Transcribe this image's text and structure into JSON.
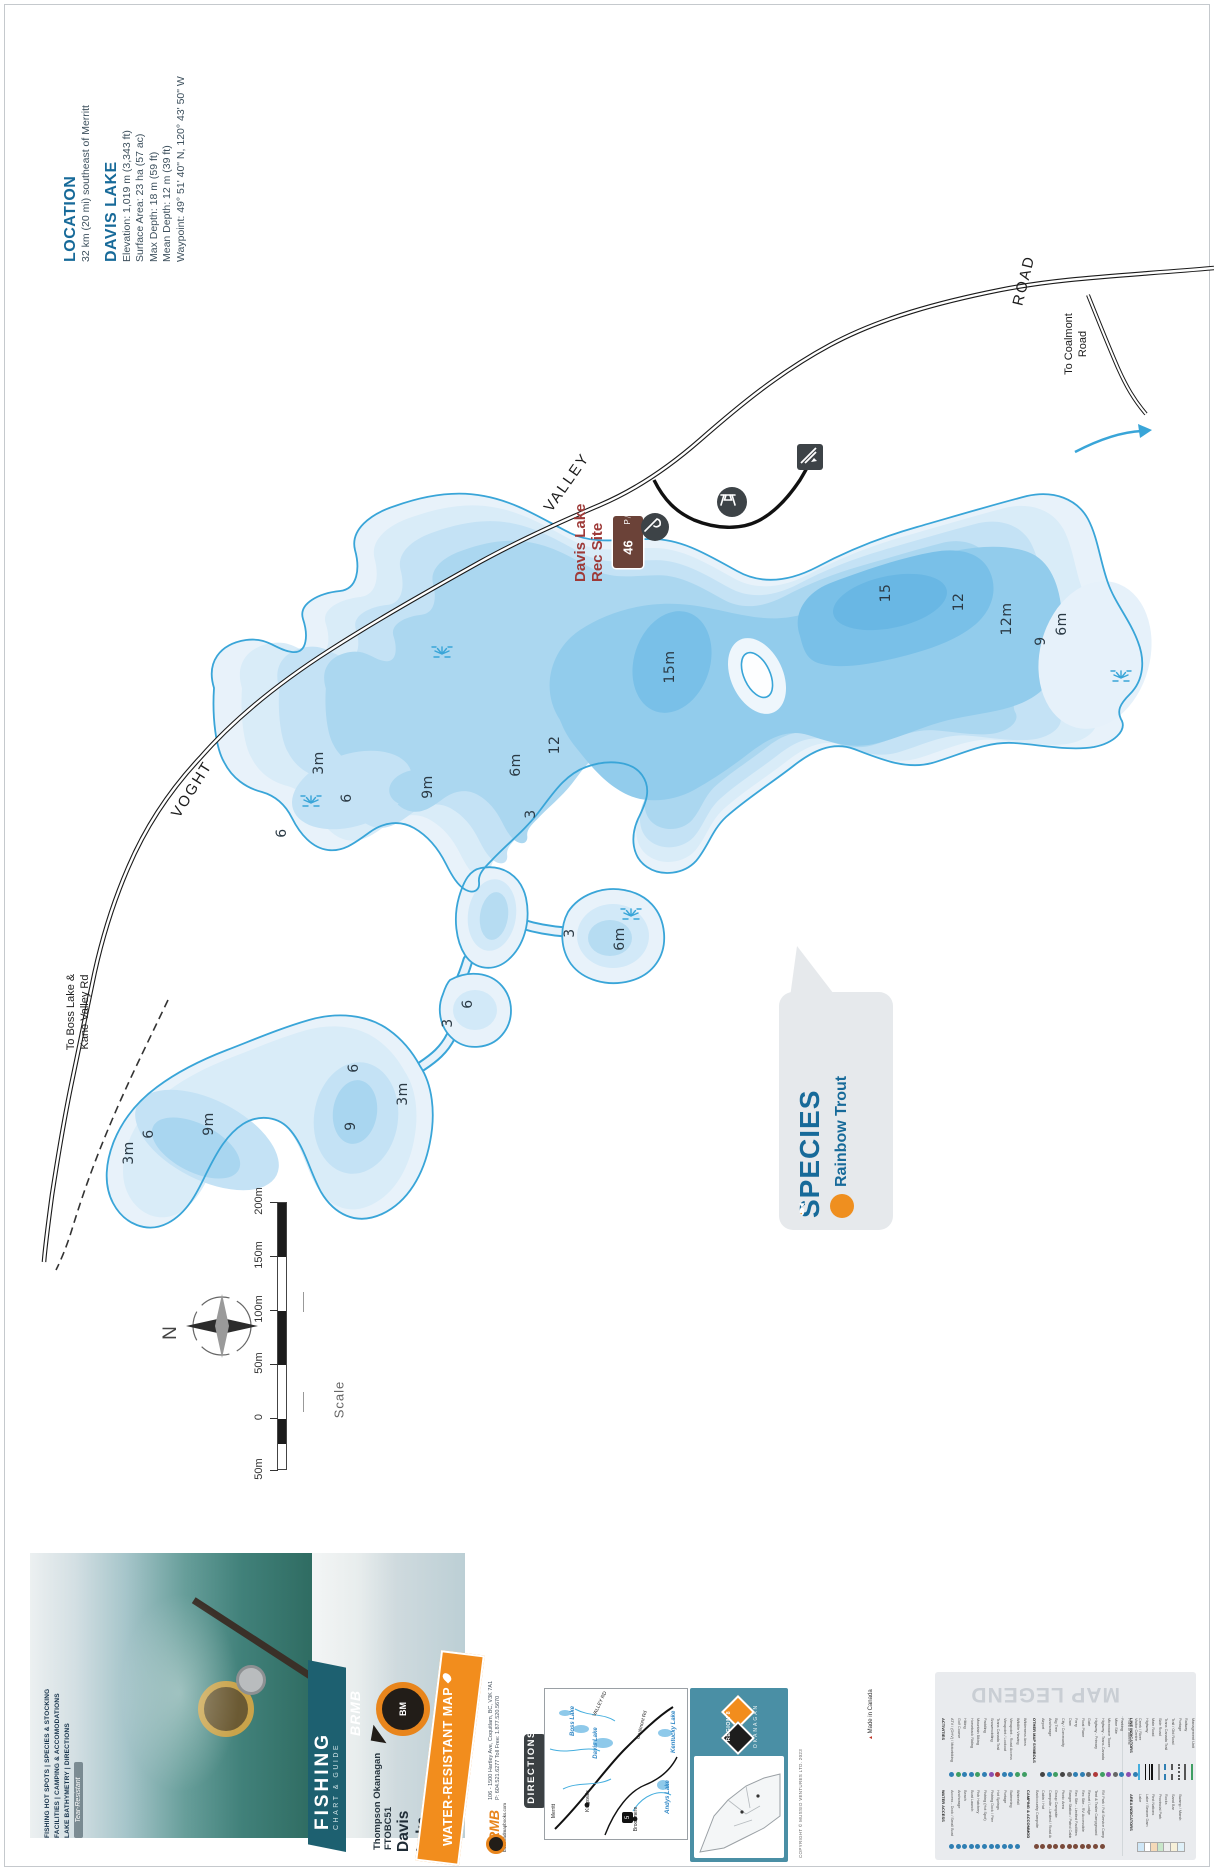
{
  "colors": {
    "contour": "#39a5d8",
    "teal_heading": "#176a99",
    "accent_orange": "#f28d1d",
    "rec_brown": "#6b4238",
    "rec_red": "#9e3a38",
    "banner_teal": "#1d6070",
    "region_bg": "#4a8fa5"
  },
  "info": {
    "location_heading": "LOCATION",
    "location_text": "32 km (20 mi) southeast of Merritt",
    "lake_heading": "DAVIS LAKE",
    "details": [
      "Elevation: 1,019 m (3,343 ft)",
      "Surface Area: 23 ha (57 ac)",
      "Max Depth: 18 m (59 ft)",
      "Mean Depth: 12 m (39 ft)",
      "Waypoint: 49° 51' 40\" N, 120° 43' 50\" W"
    ]
  },
  "roads": {
    "labels": [
      {
        "text": "VOGHT",
        "x": 192,
        "y": 790,
        "rot": -58
      },
      {
        "text": "VALLEY",
        "x": 567,
        "y": 483,
        "rot": -55
      },
      {
        "text": "ROAD",
        "x": 1024,
        "y": 281,
        "rot": -76
      }
    ],
    "destinations": [
      {
        "lines": [
          "To Boss Lake &",
          "Kane Valley Rd"
        ],
        "x": 64,
        "bottom": 1062,
        "w": 100
      },
      {
        "lines": [
          "To Coalmont",
          "Road"
        ],
        "x": 1062,
        "bottom": 392,
        "w": 96
      }
    ]
  },
  "rec_site": {
    "label_line1": "Davis Lake",
    "label_line2": "Rec Site",
    "sign_number": "46",
    "sign_glyphs": "P⧸▲"
  },
  "species": {
    "heading": "SPECIES",
    "name": "Rainbow Trout"
  },
  "depth_labels": [
    {
      "t": "15m",
      "x": 670,
      "y": 668
    },
    {
      "t": "15",
      "x": 886,
      "y": 594
    },
    {
      "t": "12",
      "x": 959,
      "y": 603
    },
    {
      "t": "12m",
      "x": 1007,
      "y": 620
    },
    {
      "t": "9",
      "x": 1041,
      "y": 642
    },
    {
      "t": "6m",
      "x": 1062,
      "y": 625
    },
    {
      "t": "12",
      "x": 555,
      "y": 746
    },
    {
      "t": "6m",
      "x": 516,
      "y": 766
    },
    {
      "t": "3",
      "x": 531,
      "y": 815
    },
    {
      "t": "9m",
      "x": 428,
      "y": 788
    },
    {
      "t": "6",
      "x": 347,
      "y": 799
    },
    {
      "t": "3m",
      "x": 319,
      "y": 764
    },
    {
      "t": "6",
      "x": 282,
      "y": 834
    },
    {
      "t": "3",
      "x": 570,
      "y": 934
    },
    {
      "t": "6m",
      "x": 620,
      "y": 940
    },
    {
      "t": "6",
      "x": 468,
      "y": 1005
    },
    {
      "t": "3",
      "x": 448,
      "y": 1024
    },
    {
      "t": "6",
      "x": 354,
      "y": 1069
    },
    {
      "t": "3m",
      "x": 403,
      "y": 1095
    },
    {
      "t": "9",
      "x": 351,
      "y": 1127
    },
    {
      "t": "9m",
      "x": 209,
      "y": 1125
    },
    {
      "t": "6",
      "x": 149,
      "y": 1135
    },
    {
      "t": "3m",
      "x": 129,
      "y": 1154
    }
  ],
  "marsh_icons": [
    {
      "x": 442,
      "y": 651
    },
    {
      "x": 311,
      "y": 800
    },
    {
      "x": 631,
      "y": 913
    },
    {
      "x": 1121,
      "y": 675
    }
  ],
  "compass": {
    "label": "N"
  },
  "scale": {
    "label": "Scale",
    "ticks": [
      "200m",
      "150m",
      "100m",
      "50m",
      "0",
      "50m"
    ]
  },
  "strip": {
    "photo": {
      "captions": [
        "FISHING HOT SPOTS | SPECIES & STOCKING",
        "FACILITIES | CAMPING & ACCOMODATIONS",
        "LAKE BATHYMETRY | DIRECTIONS"
      ],
      "tag": "Tear-Resistant"
    },
    "cover": {
      "brand": "BRMB",
      "badge": "BM",
      "series": "FISHING",
      "series_sub": "CHART & GUIDE",
      "region_line": "Thompson Okanagan FTOBC51",
      "title_line1": "Davis",
      "title_line2": "Lake",
      "band": "WATER-RESISTANT MAP"
    },
    "contact": {
      "address": "106 - 1500 Hartley Ave, Coquitlam, BC, V3K 7A1",
      "phone": "P: 604.521.6277   Toll Free: 1.877.520.5670",
      "brand": "BRMB",
      "site": "backroadmapbooks.com",
      "copyright": "COPYRIGHT © MUSSIO VENTURES LTD. 2023",
      "madein": "Made in Canada"
    },
    "directions": {
      "tab": "DIRECTIONS",
      "inset_labels": [
        {
          "t": "VALLEY RD",
          "x": 600,
          "y": 1705,
          "rot": -65,
          "cls": ""
        },
        {
          "t": "Davis Lake",
          "x": 596,
          "y": 1744,
          "rot": -90,
          "cls": "blue"
        },
        {
          "t": "Boss Lake",
          "x": 573,
          "y": 1722,
          "rot": -90,
          "cls": "blue"
        },
        {
          "t": "Andys Lake",
          "x": 668,
          "y": 1798,
          "rot": -90,
          "cls": "blue"
        },
        {
          "t": "Kentucky Lake",
          "x": 674,
          "y": 1736,
          "rot": -90,
          "cls": "blue"
        },
        {
          "t": "Kingsvale",
          "x": 588,
          "y": 1802,
          "rot": -90,
          "cls": ""
        },
        {
          "t": "Brookmere",
          "x": 636,
          "y": 1820,
          "rot": -90,
          "cls": ""
        },
        {
          "t": "Merritt",
          "x": 554,
          "y": 1812,
          "rot": -90,
          "cls": ""
        },
        {
          "t": "Coalmont Rd",
          "x": 642,
          "y": 1726,
          "rot": -75,
          "cls": ""
        }
      ],
      "shield": "5"
    },
    "region": {
      "badge": "REGION 8",
      "caption": "OKANAGAN"
    },
    "legend": {
      "title": "MAP LEGEND",
      "groups_row1": [
        {
          "header": "ACTIVITIES",
          "items": [
            [
              "ATV / (OHV) / Motorbiking",
              "#2f7fb3"
            ],
            [
              "Golf Course",
              "#3f9e63"
            ],
            [
              "Hiking",
              "#2f7fb3"
            ],
            [
              "Horseback Riding",
              "#2f7fb3"
            ],
            [
              "Mountain Biking",
              "#3f9e63"
            ],
            [
              "Paddling",
              "#2f7fb3"
            ],
            [
              "Snowmobiling",
              "#8a4fb0"
            ],
            [
              "Trans Canada Trail",
              "#b03a3a"
            ],
            [
              "Viewpoint / Lookout",
              "#2f7fb3"
            ],
            [
              "Viewpoint - Road Access",
              "#2f7fb3"
            ],
            [
              "Wildlife Viewing",
              "#3f9e63"
            ],
            [
              "Wilderness Area",
              "#3f9e63"
            ]
          ]
        },
        {
          "header": "OTHER MAP SYMBOLS",
          "items": [
            [
              "Airport",
              "#444"
            ],
            [
              "Anchorage",
              "#2f7fb3"
            ],
            [
              "Big Tree",
              "#3f9e63"
            ],
            [
              "City / Community",
              "#444"
            ],
            [
              "Dam",
              "#666"
            ],
            [
              "Ferry",
              "#2f7fb3"
            ],
            [
              "Float Plane",
              "#2f7fb3"
            ],
            [
              "Gate",
              "#666"
            ],
            [
              "Highway - Primary",
              "#b03a3a"
            ],
            [
              "Highway - Trans-Canada",
              "#3f9e63"
            ],
            [
              "Microwave Tower",
              "#8a4fb0"
            ],
            [
              "Mine Site",
              "#666"
            ],
            [
              "Parking",
              "#2f7fb3"
            ],
            [
              "Point of Interest",
              "#8a4fb0"
            ],
            [
              "Visitor Centre",
              "#2f7fb3"
            ]
          ]
        }
      ],
      "groups_row2": [
        {
          "header": "WATER ACCESS",
          "items": [
            [
              "Access - Dock / Small Boat",
              "#2f7fb3"
            ],
            [
              "Anchorage",
              "#2f7fb3"
            ],
            [
              "Beach",
              "#2f7fb3"
            ],
            [
              "Boat Launch",
              "#2f7fb3"
            ],
            [
              "Fish Hatchery",
              "#2f7fb3"
            ],
            [
              "Fishing (Hot Spot)",
              "#2f7fb3"
            ],
            [
              "Fishing Dock / Pier",
              "#2f7fb3"
            ],
            [
              "Hot Springs",
              "#2f7fb3"
            ],
            [
              "Portage",
              "#2f7fb3"
            ],
            [
              "Swimming",
              "#2f7fb3"
            ],
            [
              "Waterfall",
              "#2f7fb3"
            ]
          ]
        },
        {
          "header": "CAMPING & ACCOMMODATIONS",
          "items": [
            [
              "Backcountry Campsite",
              "#7a4a3a"
            ],
            [
              "Cabin / Hut",
              "#7a4a3a"
            ],
            [
              "Campsite - Limited / Road Access",
              "#7a4a3a"
            ],
            [
              "Group Campsite",
              "#7a4a3a"
            ],
            [
              "Picnic Area",
              "#7a4a3a"
            ],
            [
              "Ranger Station / Patrol Cabin",
              "#7a4a3a"
            ],
            [
              "Rec Site - Limited Facilities",
              "#7a4a3a"
            ],
            [
              "Rec Site - RV Accessible",
              "#7a4a3a"
            ],
            [
              "Resort / Lodge",
              "#7a4a3a"
            ],
            [
              "Tent & Trailer Campground",
              "#7a4a3a"
            ],
            [
              "RV Park / Full Service Campground",
              "#7a4a3a"
            ]
          ]
        }
      ],
      "line_indicators": {
        "header": "LINE INDICATORS",
        "items": [
          [
            "Creek / River",
            "blue"
          ],
          [
            "Highway",
            "double"
          ],
          [
            "Main Road",
            "solid"
          ],
          [
            "Side Road",
            "gray"
          ],
          [
            "Trans Canada Trail",
            "dashdot"
          ],
          [
            "Trail / Old Road",
            "dashed"
          ],
          [
            "Portage",
            "dotted"
          ],
          [
            "Railway",
            "ticked"
          ],
          [
            "Management Unit",
            "green"
          ]
        ]
      },
      "area_indicators": {
        "header": "AREA INDICATORS",
        "items": [
          [
            "Lake",
            "#cfe7f7"
          ],
          [
            "Lake / Beaver Dam",
            "#ffffff"
          ],
          [
            "First Nations",
            "#f5d9b8"
          ],
          [
            "Provincial Park",
            "#c8e6c9"
          ],
          [
            "Rocks",
            "#eeeeee"
          ],
          [
            "Sand Bar",
            "#f7f0d8"
          ],
          [
            "Swamp / Marsh",
            "#dff0f8"
          ]
        ]
      }
    }
  }
}
